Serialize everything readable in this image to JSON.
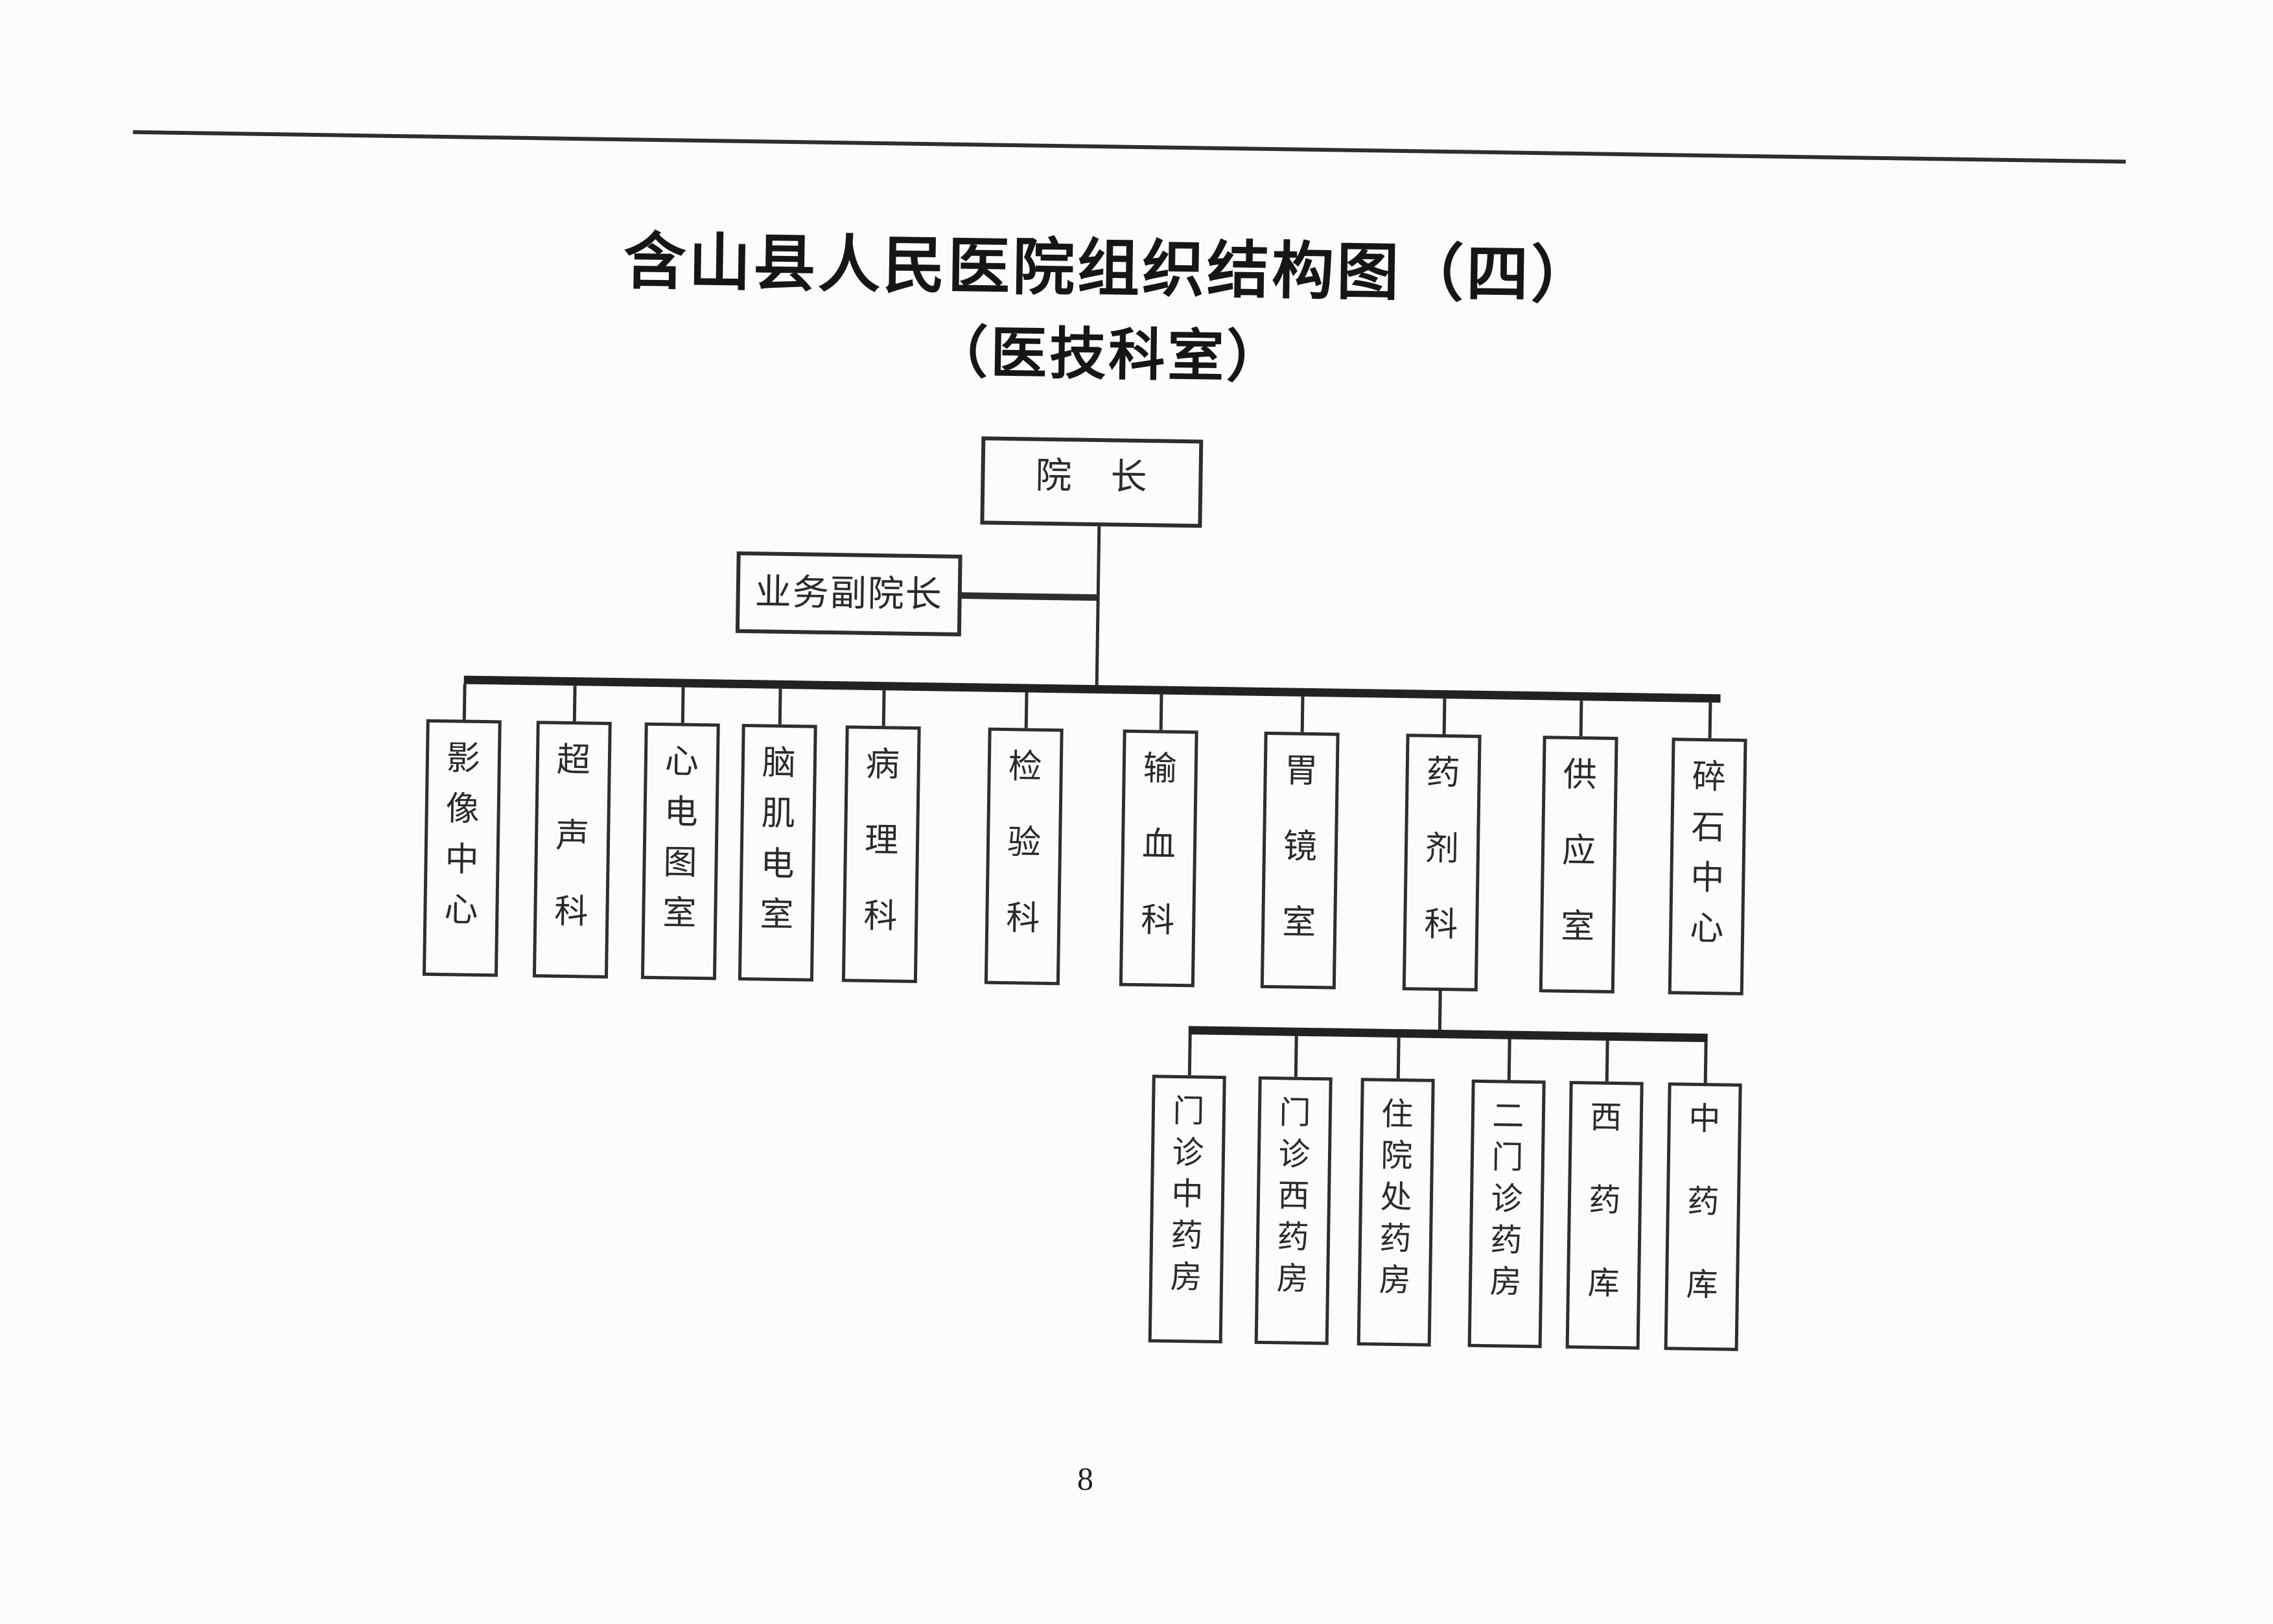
{
  "page": {
    "title": "含山县人民医院组织结构图（四）",
    "subtitle": "（医技科室）",
    "page_number": "8"
  },
  "org": {
    "root": {
      "label": "院　长"
    },
    "vice": {
      "label": "业务副院长"
    },
    "departments": [
      {
        "label": "影像中心"
      },
      {
        "label": "超声科"
      },
      {
        "label": "心电图室"
      },
      {
        "label": "脑肌电室"
      },
      {
        "label": "病理科"
      },
      {
        "label": "检验科"
      },
      {
        "label": "输血科"
      },
      {
        "label": "胃镜室"
      },
      {
        "label": "药剂科"
      },
      {
        "label": "供应室"
      },
      {
        "label": "碎石中心"
      }
    ],
    "pharmacy_sub": [
      {
        "label": "门诊中药房"
      },
      {
        "label": "门诊西药房"
      },
      {
        "label": "住院处药房"
      },
      {
        "label": "二门诊药房"
      },
      {
        "label": "西药库"
      },
      {
        "label": "中药库"
      }
    ]
  },
  "colors": {
    "ink": "#2e2e2e",
    "ink-heavy": "#222222",
    "paper": "#fcfcfb",
    "text": "#2a2a2a"
  }
}
